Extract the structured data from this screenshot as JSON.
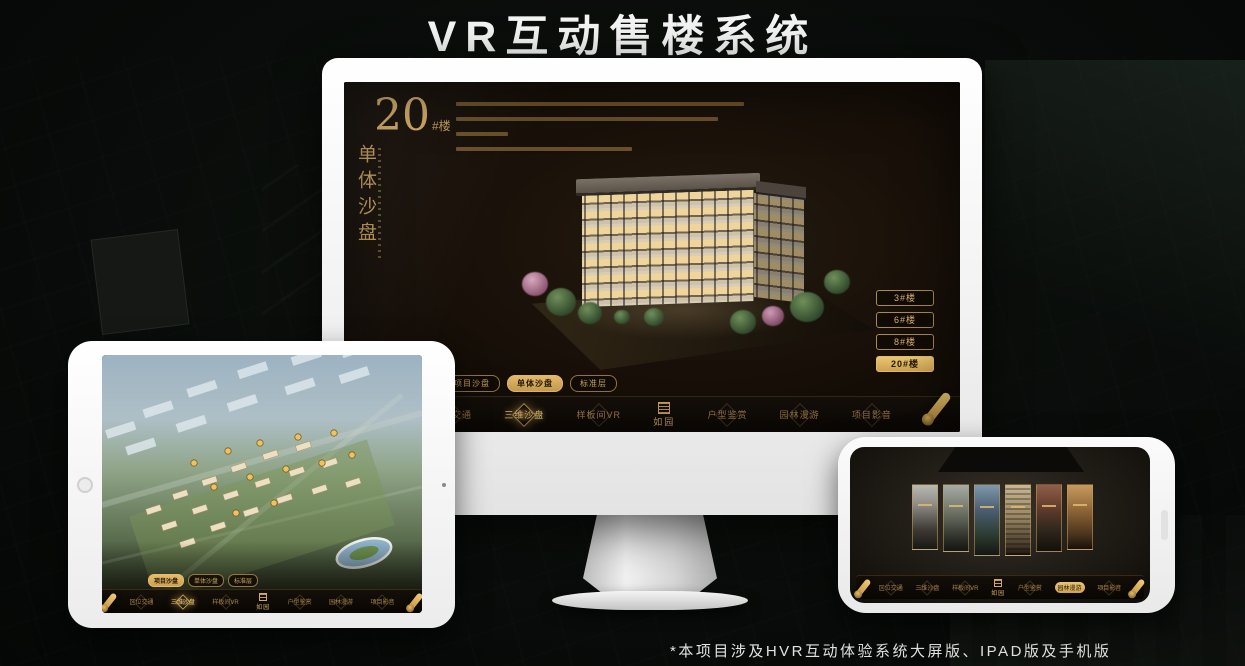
{
  "title": "VR互动售楼系统",
  "footnote": "*本项目涉及HVR互动体验系统大屏版、IPAD版及手机版",
  "colors": {
    "gold": "#c9a25e",
    "gold_selected": "#d9ac5f",
    "screen_bg": "#17110a",
    "device_white": "#f4f4f4"
  },
  "brand": {
    "logo_text": "如园"
  },
  "monitor": {
    "headline": {
      "number": "20",
      "suffix": "#楼",
      "vertical": "单体沙盘"
    },
    "building_buttons": [
      {
        "label": "3#楼",
        "selected": false
      },
      {
        "label": "6#楼",
        "selected": false
      },
      {
        "label": "8#楼",
        "selected": false
      },
      {
        "label": "20#楼",
        "selected": true
      }
    ],
    "sub_tabs": [
      {
        "label": "项目沙盘",
        "selected": false
      },
      {
        "label": "单体沙盘",
        "selected": true
      },
      {
        "label": "标准层",
        "selected": false
      }
    ],
    "nav": {
      "left": [
        "区位交通",
        "三维沙盘",
        "样板间VR"
      ],
      "right": [
        "户型鉴赏",
        "园林漫游",
        "项目影音"
      ],
      "selected": "三维沙盘",
      "logo": "如园"
    }
  },
  "ipad": {
    "sub_tabs": [
      {
        "label": "项目沙盘",
        "selected": true
      },
      {
        "label": "单体沙盘",
        "selected": false
      },
      {
        "label": "标准层",
        "selected": false
      }
    ],
    "nav": {
      "left": [
        "区位交通",
        "三维沙盘",
        "样板间VR"
      ],
      "right": [
        "户型鉴赏",
        "园林漫游",
        "项目影音"
      ],
      "selected": "三维沙盘",
      "logo": "如园"
    }
  },
  "phone": {
    "gallery_panel_count": 6,
    "nav": {
      "left": [
        "区位交通",
        "三维沙盘",
        "样板间VR"
      ],
      "right": [
        "户型鉴赏",
        "园林漫游",
        "项目影音"
      ],
      "selected": "园林漫游",
      "logo": "如园"
    }
  }
}
